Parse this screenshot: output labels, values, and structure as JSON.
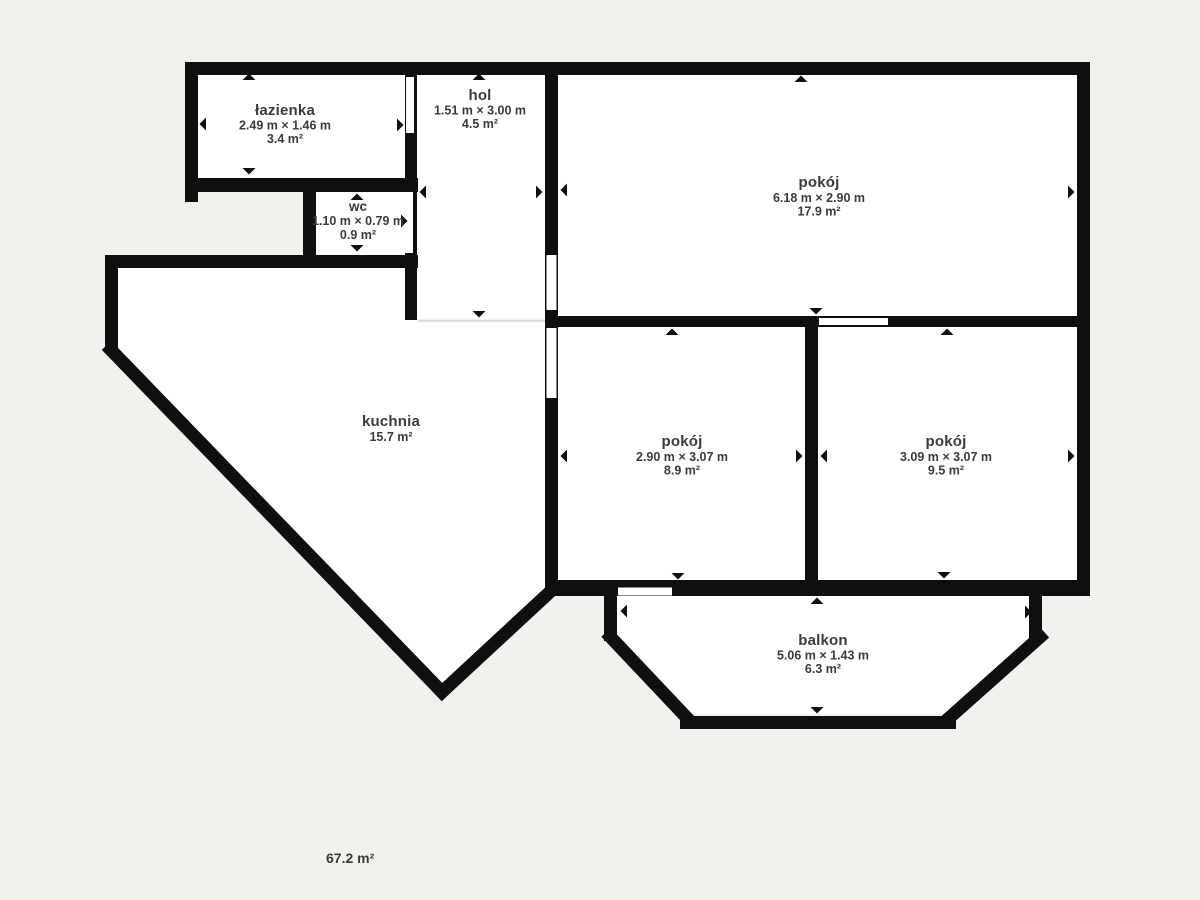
{
  "plan": {
    "background_color": "#f2f1ed",
    "wall_color": "#0f0f0f",
    "room_fill_color": "#ffffff",
    "text_color": "#3b3b3b",
    "total_area": "67.2 m²",
    "rooms": [
      {
        "name": "łazienka",
        "dimensions": "2.49 m × 1.46 m",
        "area": "3.4 m²"
      },
      {
        "name": "wc",
        "dimensions": "1.10 m × 0.79 m",
        "area": "0.9 m²"
      },
      {
        "name": "hol",
        "dimensions": "1.51 m × 3.00 m",
        "area": "4.5 m²"
      },
      {
        "name": "pokój",
        "dimensions": "6.18 m × 2.90 m",
        "area": "17.9 m²"
      },
      {
        "name": "kuchnia",
        "area": "15.7 m²"
      },
      {
        "name": "pokój",
        "dimensions": "2.90 m × 3.07 m",
        "area": "8.9 m²"
      },
      {
        "name": "pokój",
        "dimensions": "3.09 m × 3.07 m",
        "area": "9.5 m²"
      },
      {
        "name": "balkon",
        "dimensions": "5.06 m × 1.43 m",
        "area": "6.3 m²"
      }
    ]
  }
}
